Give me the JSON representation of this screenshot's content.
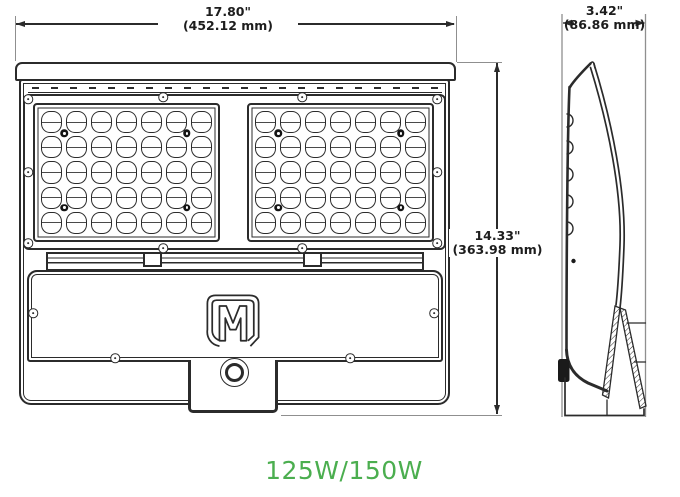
{
  "dimensions": {
    "width": {
      "inches": "17.80\"",
      "millimeters": "(452.12 mm)"
    },
    "height": {
      "inches": "14.33\"",
      "millimeters": "(363.98 mm)"
    },
    "depth": {
      "inches": "3.42\"",
      "millimeters": "(86.86 mm)"
    }
  },
  "wattage_label": "125W/150W",
  "front_view": {
    "led_modules": {
      "count": 2,
      "columns": 7,
      "rows": 5
    },
    "logo_letter": "M"
  },
  "colors": {
    "line": "#2b2b2b",
    "extension_line": "#8f8f8f",
    "accent_green": "#4bae4f",
    "background": "#ffffff"
  },
  "icons": [
    "screw-icon",
    "module-screw-icon",
    "led-lens",
    "m-logo",
    "photocell-knob-icon",
    "heat-fins",
    "mounting-bracket",
    "dimension-arrow"
  ]
}
